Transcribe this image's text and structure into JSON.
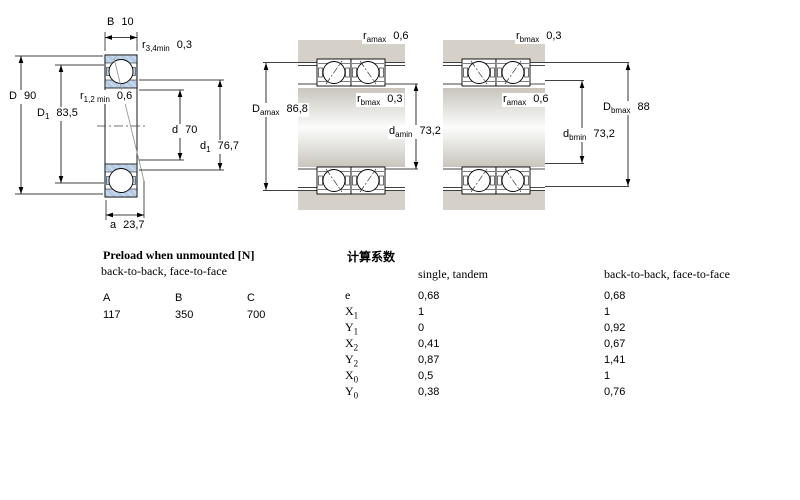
{
  "colors": {
    "bearing_fill": "#b6cce4",
    "bearing_hatch": "#dde8f4",
    "housing_gray": "#d5d1c9",
    "background": "#ffffff",
    "line": "#000000"
  },
  "dims": {
    "B": {
      "sym": "B",
      "sub": "",
      "val": "10"
    },
    "r34": {
      "sym": "r",
      "sub": "3,4min",
      "val": "0,3"
    },
    "D": {
      "sym": "D",
      "sub": "",
      "val": "90"
    },
    "D1": {
      "sym": "D",
      "sub": "1",
      "val": "83,5"
    },
    "r12": {
      "sym": "r",
      "sub": "1,2 min",
      "val": "0,6"
    },
    "d": {
      "sym": "d",
      "sub": "",
      "val": "70"
    },
    "d1": {
      "sym": "d",
      "sub": "1",
      "val": "76,7"
    },
    "a": {
      "sym": "a",
      "sub": "",
      "val": "23,7"
    },
    "ramax_mid": {
      "sym": "r",
      "sub": "amax",
      "val": "0,6"
    },
    "Damax": {
      "sym": "D",
      "sub": "amax",
      "val": "86,8"
    },
    "rbmax_mid": {
      "sym": "r",
      "sub": "bmax",
      "val": "0,3"
    },
    "damin": {
      "sym": "d",
      "sub": "amin",
      "val": "73,2"
    },
    "rbmax_right": {
      "sym": "r",
      "sub": "bmax",
      "val": "0,3"
    },
    "ramax_right": {
      "sym": "r",
      "sub": "amax",
      "val": "0,6"
    },
    "dbmin": {
      "sym": "d",
      "sub": "bmin",
      "val": "73,2"
    },
    "Dbmax": {
      "sym": "D",
      "sub": "bmax",
      "val": "88"
    }
  },
  "preload": {
    "title": "Preload when unmounted [N]",
    "subtitle": "back-to-back, face-to-face",
    "columns": [
      "A",
      "B",
      "C"
    ],
    "values": [
      "117",
      "350",
      "700"
    ]
  },
  "factors": {
    "title": "计算系数",
    "col1_header": "single, tandem",
    "col2_header": "back-to-back, face-to-face",
    "rows": [
      {
        "sym": "e",
        "sub": "",
        "v1": "0,68",
        "v2": "0,68"
      },
      {
        "sym": "X",
        "sub": "1",
        "v1": "1",
        "v2": "1"
      },
      {
        "sym": "Y",
        "sub": "1",
        "v1": "0",
        "v2": "0,92"
      },
      {
        "sym": "X",
        "sub": "2",
        "v1": "0,41",
        "v2": "0,67"
      },
      {
        "sym": "Y",
        "sub": "2",
        "v1": "0,87",
        "v2": "1,41"
      },
      {
        "sym": "X",
        "sub": "0",
        "v1": "0,5",
        "v2": "1"
      },
      {
        "sym": "Y",
        "sub": "0",
        "v1": "0,38",
        "v2": "0,76"
      }
    ]
  }
}
